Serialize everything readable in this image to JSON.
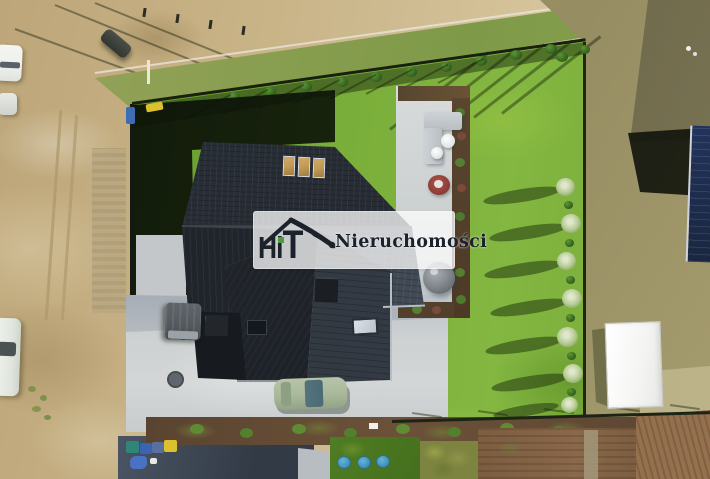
{
  "watermark": {
    "brand": "HiT",
    "letters": {
      "h": "H",
      "i": "i",
      "t": "T"
    },
    "wordmark": "Nieruchomości"
  },
  "colors": {
    "sand": "#c9b488",
    "sand_light": "#d6c49c",
    "sand_dark2": "#bda679",
    "lawn": "#79ad39",
    "lawn_dark": "#5d8f26",
    "verge": "#8fa054",
    "scrub": "#a39a6d",
    "scrub_dark": "#5f5c44",
    "roof_dark": "#262b33",
    "roof_mid": "#343b44",
    "roof_light": "#46505c",
    "skylight_amber": "#c29a55",
    "concrete": "#cdd1d2",
    "concrete_shadow": "#3e4651",
    "shed_white": "#f4f5f3",
    "mulch": "#57432e",
    "soil": "#8a6845",
    "shadow_green": "#0f150b",
    "tree_pale": "#dfe8cc",
    "car_white": "#eef0ec",
    "car_green": "#a9b89a",
    "van_gray": "#54595e",
    "bin_yellow": "#ddc02d",
    "bin_blue": "#3a63b4",
    "bin_teal": "#2f8577",
    "bag_blue": "#4a72c4",
    "mailbox_blue": "#3e6db5",
    "neighbor_navy": "#22335c",
    "pool_blue": "#3f8fb5",
    "wm_panel": "rgba(253,253,253,0.76)",
    "wm_ink": "#1b222b",
    "wm_accent": "#4f9a3c"
  }
}
